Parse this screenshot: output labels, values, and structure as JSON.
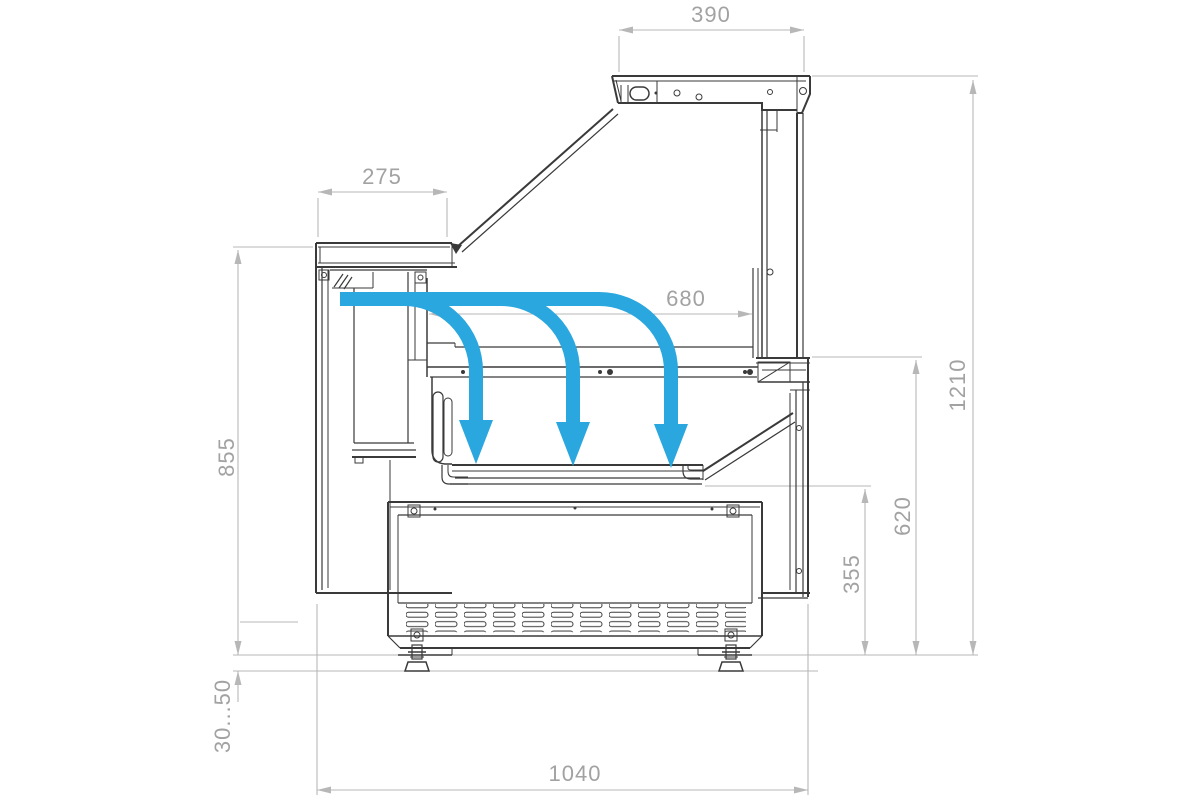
{
  "drawing": {
    "kind": "side-section technical drawing of a refrigerated serve-over display counter",
    "colors": {
      "outline": "#3a3a3a",
      "dimension_lines": "#b7b7b7",
      "dimension_text": "#a2a2a2",
      "airflow": "#2aa7df",
      "background": "#ffffff"
    },
    "airflow": {
      "arrow_count": 3
    }
  },
  "dims": {
    "canopy_width": "390",
    "worktop_depth": "275",
    "display_opening_depth": "680",
    "rear_height": "855",
    "overall_height": "1210",
    "front_glass_level_height": "620",
    "front_panel_height": "355",
    "adjustable_feet_range": "30...50",
    "overall_depth": "1040"
  }
}
